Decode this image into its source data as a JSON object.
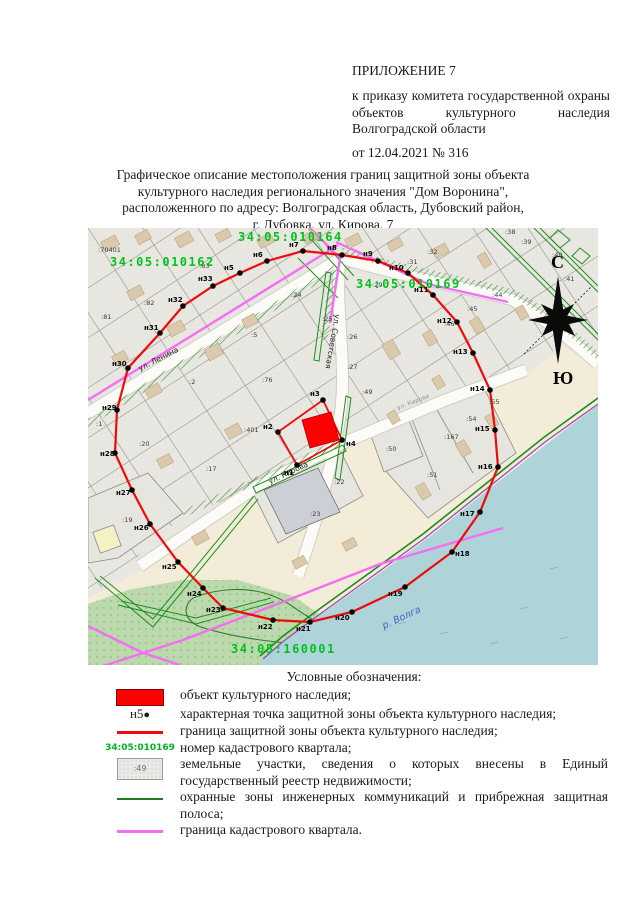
{
  "header": {
    "appendix": "ПРИЛОЖЕНИЕ 7",
    "order_text": "к приказу комитета государственной охраны объектов культурного наследия Волгоградской области",
    "order_date_line": "от 12.04.2021 № 316"
  },
  "title_lines": [
    "Графическое описание местоположения границ защитной зоны объекта",
    "культурного наследия регионального значения \"Дом Воронина\",",
    "расположенного по адресу: Волгоградская область, Дубовский район,",
    "г. Дубовка, ул. Кирова, 7"
  ],
  "map": {
    "quarter_labels": [
      {
        "text": "34:05:010162",
        "x": 22,
        "y": 38
      },
      {
        "text": "34:05:010164",
        "x": 150,
        "y": 13
      },
      {
        "text": "34:05:010169",
        "x": 268,
        "y": 60
      },
      {
        "text": "34:05:160001",
        "x": 143,
        "y": 425
      }
    ],
    "street_labels": [
      {
        "text": "ул. Ленина",
        "x": 52,
        "y": 143,
        "rot": -27,
        "small": false
      },
      {
        "text": "ул. Советская",
        "x": 247,
        "y": 86,
        "rot": 100,
        "small": false
      },
      {
        "text": "ул. Кирова",
        "x": 182,
        "y": 256,
        "rot": -25,
        "small": false
      },
      {
        "text": "ул. Кирова",
        "x": 310,
        "y": 182,
        "rot": -22,
        "small": true
      }
    ],
    "river_label": {
      "text": "р. Волга",
      "x": 296,
      "y": 401,
      "rot": -25
    },
    "compass": {
      "north": "С",
      "south": "Ю"
    },
    "zone_points": [
      {
        "n": "н5",
        "x": 152,
        "y": 45,
        "dx": -16,
        "dy": -3
      },
      {
        "n": "н6",
        "x": 179,
        "y": 33,
        "dx": -14,
        "dy": -4
      },
      {
        "n": "н7",
        "x": 215,
        "y": 23,
        "dx": -14,
        "dy": -4
      },
      {
        "n": "н8",
        "x": 254,
        "y": 27,
        "dx": -15,
        "dy": -5
      },
      {
        "n": "н9",
        "x": 290,
        "y": 33,
        "dx": -15,
        "dy": -5
      },
      {
        "n": "н10",
        "x": 320,
        "y": 45,
        "dx": -19,
        "dy": -3
      },
      {
        "n": "н11",
        "x": 345,
        "y": 67,
        "dx": -19,
        "dy": -3
      },
      {
        "n": "н12",
        "x": 369,
        "y": 94,
        "dx": -20,
        "dy": 1
      },
      {
        "n": "н13",
        "x": 385,
        "y": 125,
        "dx": -20,
        "dy": 1
      },
      {
        "n": "н14",
        "x": 402,
        "y": 162,
        "dx": -20,
        "dy": 1
      },
      {
        "n": "н15",
        "x": 407,
        "y": 202,
        "dx": -20,
        "dy": 1
      },
      {
        "n": "н16",
        "x": 410,
        "y": 239,
        "dx": -20,
        "dy": 2
      },
      {
        "n": "н17",
        "x": 392,
        "y": 284,
        "dx": -20,
        "dy": 4
      },
      {
        "n": "н18",
        "x": 364,
        "y": 324,
        "dx": 3,
        "dy": 4
      },
      {
        "n": "н19",
        "x": 317,
        "y": 359,
        "dx": -17,
        "dy": 9
      },
      {
        "n": "н20",
        "x": 264,
        "y": 384,
        "dx": -17,
        "dy": 8
      },
      {
        "n": "н21",
        "x": 222,
        "y": 394,
        "dx": -14,
        "dy": 9
      },
      {
        "n": "н22",
        "x": 185,
        "y": 392,
        "dx": -15,
        "dy": 9
      },
      {
        "n": "н23",
        "x": 135,
        "y": 380,
        "dx": -17,
        "dy": 4
      },
      {
        "n": "н24",
        "x": 115,
        "y": 360,
        "dx": -16,
        "dy": 8
      },
      {
        "n": "н25",
        "x": 90,
        "y": 334,
        "dx": -16,
        "dy": 7
      },
      {
        "n": "н26",
        "x": 62,
        "y": 296,
        "dx": -16,
        "dy": 6
      },
      {
        "n": "н27",
        "x": 44,
        "y": 262,
        "dx": -16,
        "dy": 5
      },
      {
        "n": "н28",
        "x": 27,
        "y": 225,
        "dx": -15,
        "dy": 3
      },
      {
        "n": "н29",
        "x": 29,
        "y": 182,
        "dx": -15,
        "dy": 0
      },
      {
        "n": "н30",
        "x": 40,
        "y": 140,
        "dx": -16,
        "dy": -2
      },
      {
        "n": "н31",
        "x": 72,
        "y": 105,
        "dx": -16,
        "dy": -3
      },
      {
        "n": "н32",
        "x": 95,
        "y": 78,
        "dx": -15,
        "dy": -4
      },
      {
        "n": "н33",
        "x": 125,
        "y": 58,
        "dx": -15,
        "dy": -5
      }
    ],
    "object_points": [
      {
        "n": "н1",
        "x": 209,
        "y": 237,
        "dx": -13,
        "dy": 10
      },
      {
        "n": "н2",
        "x": 190,
        "y": 204,
        "dx": -15,
        "dy": -3
      },
      {
        "n": "н3",
        "x": 235,
        "y": 172,
        "dx": -13,
        "dy": -4
      },
      {
        "n": "н4",
        "x": 254,
        "y": 212,
        "dx": 4,
        "dy": 6
      }
    ],
    "parcel_labels": [
      {
        "text": ":70401",
        "x": 10,
        "y": 24
      },
      {
        "text": ":83",
        "x": 111,
        "y": 40
      },
      {
        "text": ":82",
        "x": 56,
        "y": 77
      },
      {
        "text": ":81",
        "x": 13,
        "y": 91
      },
      {
        "text": ":1",
        "x": 8,
        "y": 198
      },
      {
        "text": ":2",
        "x": 101,
        "y": 156
      },
      {
        "text": ":5",
        "x": 163,
        "y": 109
      },
      {
        "text": ":76",
        "x": 174,
        "y": 154
      },
      {
        "text": ":20",
        "x": 51,
        "y": 218
      },
      {
        "text": ":17",
        "x": 118,
        "y": 243
      },
      {
        "text": ":401",
        "x": 156,
        "y": 204
      },
      {
        "text": ":19",
        "x": 34,
        "y": 294
      },
      {
        "text": ":24",
        "x": 203,
        "y": 69
      },
      {
        "text": ":25",
        "x": 234,
        "y": 93
      },
      {
        "text": ":26",
        "x": 259,
        "y": 111
      },
      {
        "text": ":27",
        "x": 259,
        "y": 141
      },
      {
        "text": ":29",
        "x": 284,
        "y": 59
      },
      {
        "text": ":31",
        "x": 319,
        "y": 36
      },
      {
        "text": ":32",
        "x": 339,
        "y": 26
      },
      {
        "text": ":38",
        "x": 417,
        "y": 6
      },
      {
        "text": ":39",
        "x": 433,
        "y": 16
      },
      {
        "text": ":40",
        "x": 464,
        "y": 29
      },
      {
        "text": ":41",
        "x": 476,
        "y": 53
      },
      {
        "text": ":44",
        "x": 404,
        "y": 69
      },
      {
        "text": ":45",
        "x": 379,
        "y": 83
      },
      {
        "text": ":46",
        "x": 356,
        "y": 98
      },
      {
        "text": ":49",
        "x": 274,
        "y": 166
      },
      {
        "text": ":50",
        "x": 298,
        "y": 223
      },
      {
        "text": ":22",
        "x": 246,
        "y": 256
      },
      {
        "text": ":23",
        "x": 222,
        "y": 288
      },
      {
        "text": ":51",
        "x": 339,
        "y": 249
      },
      {
        "text": ":167",
        "x": 356,
        "y": 211
      },
      {
        "text": ":54",
        "x": 378,
        "y": 193
      },
      {
        "text": ":55",
        "x": 401,
        "y": 176
      }
    ]
  },
  "legend": {
    "title": "Условные обозначения:",
    "items": [
      {
        "swatch": "object",
        "text": "объект культурного наследия;"
      },
      {
        "swatch": "point",
        "label": "н5",
        "text": "характерная точка защитной зоны объекта культурного наследия;"
      },
      {
        "swatch": "zone-line",
        "text": "граница защитной зоны объекта культурного наследия;"
      },
      {
        "swatch": "quarter-number",
        "label": "34:05:010169",
        "text": "номер кадастрового квартала;"
      },
      {
        "swatch": "parcel",
        "label": ":49",
        "text": "земельные участки, сведения о которых внесены в Единый государственный реестр недвижимости;"
      },
      {
        "swatch": "comm-line",
        "text": "охранные зоны инженерных коммуникаций и прибрежная защитная полоса;"
      },
      {
        "swatch": "quarter-line",
        "text": "граница кадастрового квартала."
      }
    ]
  },
  "colors": {
    "zone_red": "#ee0b0b",
    "object_red": "#ff0000",
    "cadastral_green": "#00c31e",
    "comm_green": "#1d7a1d",
    "quarter_magenta": "#f46ef4",
    "water_blue": "#aed3d9"
  }
}
